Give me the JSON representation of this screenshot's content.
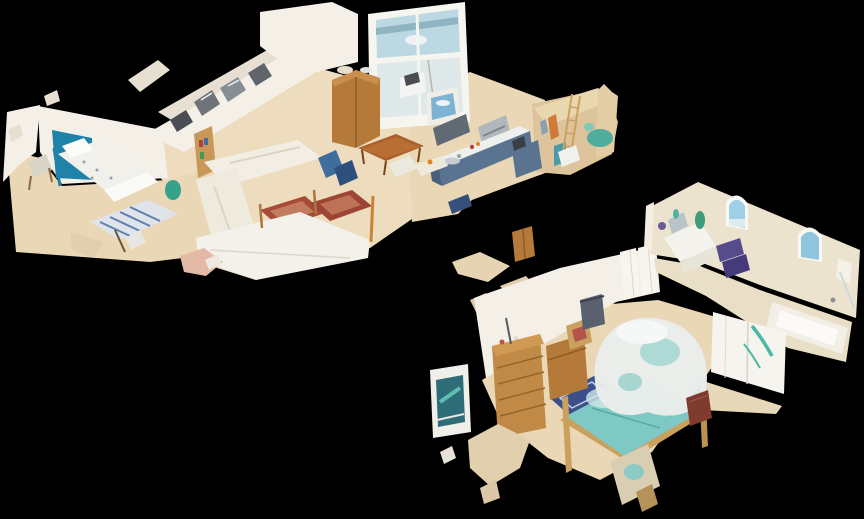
{
  "app": {
    "name": "3d-dollhouse-view",
    "description": "Cutaway 3D dollhouse scan of a single-storey home interior rendered on a black background"
  },
  "palette": {
    "background": "#000000",
    "wall_white": "#f4f0e8",
    "wall_shadow": "#e6dfd2",
    "wall_cream": "#ece3cf",
    "wall_warm": "#e9d7b0",
    "floor_wood": "#e9d7b6",
    "floor_wood_light": "#eddcbd",
    "floor_warm": "#ddc49c",
    "floor_fragment": "#e2cfae",
    "accent_wall_blue": "#1f82a8",
    "kitchen_cabinet_blue": "#5a7390",
    "kitchen_cabinet_dark": "#49607c",
    "upper_cabinet_gray": "#5f6a74",
    "hood_steel": "#b0b8bd",
    "rug_red": "#a84a38",
    "rug_red_dark": "#9c4534",
    "rug_red_inner": "#c27b5e",
    "rug_blue": "#3d4f8a",
    "runner_rug_blue": "#5f7fae",
    "bed_teal": "#7ec9c4",
    "canopy_white": "#e9edeb",
    "canopy_teal": "#9fd4cf",
    "wood_brown": "#b5793a",
    "wood_light": "#c08a46",
    "towel_purple": "#564c8c",
    "towel_purple_dark": "#453a7a",
    "plant_green": "#3f9b7a",
    "teal_decor": "#4fae9b",
    "window_sky": "#9fd0e8",
    "glass_view": "#bcd8e2",
    "mirror_gray": "#6e747a",
    "sofa_cream": "#f2eee4",
    "nightstand_red": "#7e3b2e",
    "pink_fragment": "#e3b9a6"
  },
  "scene": {
    "type": "matterport-dollhouse-cutaway",
    "view": "isometric-overhead",
    "wings": [
      {
        "name": "main-living-wing",
        "position": "upper-left",
        "rooms": [
          {
            "name": "kids-bedroom",
            "features": [
              "single-bed-white-floral",
              "blue-accent-wall",
              "striped-runner-rug",
              "wood-chair",
              "bookshelf",
              "teal-bin"
            ]
          },
          {
            "name": "hallway",
            "features": [
              "mirrored-wardrobe-doors"
            ]
          },
          {
            "name": "living-room",
            "features": [
              "cream-sofas",
              "two-red-oriental-rugs",
              "blue-exercise-equipment",
              "white-daybed"
            ]
          },
          {
            "name": "dining-area",
            "features": [
              "wood-dining-table",
              "wood-armoire",
              "printer-cabinet",
              "picture-window-with-view"
            ]
          },
          {
            "name": "kitchen",
            "features": [
              "blue-island",
              "range-hood",
              "upper-cabinets",
              "glazed-window-wall",
              "sink"
            ]
          },
          {
            "name": "utility-room",
            "features": [
              "ladder",
              "hanging-clothes",
              "teal-basket",
              "white-appliance"
            ]
          }
        ]
      },
      {
        "name": "master-suite-wing",
        "position": "lower-right",
        "rooms": [
          {
            "name": "master-bedroom",
            "features": [
              "teal-canopy-bed",
              "wood-dresser",
              "wood-chest",
              "blue-oriental-rug",
              "red-nightstand",
              "teal-wall-picture",
              "clothes-rack",
              "chair"
            ]
          },
          {
            "name": "bathroom",
            "features": [
              "two-arched-windows",
              "vanity-sink",
              "green-vase",
              "purple-towels",
              "bathtub",
              "white-wardrobe-teal-garment",
              "shower-corner"
            ]
          }
        ]
      }
    ]
  }
}
